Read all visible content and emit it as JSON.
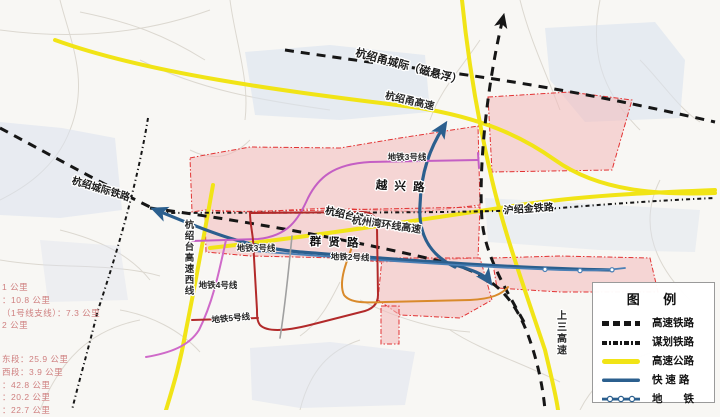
{
  "map_labels": [
    {
      "text": "杭绍甬城际（磁悬浮）"
    },
    {
      "text": "杭绍甬高速"
    },
    {
      "text": "地铁3号线"
    },
    {
      "text": "越 兴 路"
    },
    {
      "text": "杭绍城际铁路"
    },
    {
      "text": "杭绍台铁路"
    },
    {
      "text": "杭州湾环线高速"
    },
    {
      "text": "沪绍金铁路"
    },
    {
      "text": "群 贤 路"
    },
    {
      "text": "地铁3号线"
    },
    {
      "text": "地铁2号线"
    },
    {
      "text": "地铁4号线"
    },
    {
      "text": "地铁5号线"
    },
    {
      "text": "杭绍台高速西线"
    },
    {
      "text": "上三高速"
    }
  ],
  "stats": {
    "lines_a": [
      "1 公里",
      "：10.8 公里",
      "（1号线支线）：7.3 公里",
      "2 公里"
    ],
    "lines_b": [
      "东段：25.9 公里",
      "西段：3.9 公里",
      "：42.8 公里",
      "：20.2 公里",
      "：22.7 公里"
    ]
  },
  "legend": {
    "title": "图 例",
    "items": [
      {
        "label": "高速铁路",
        "swatch": "black-dashed-line"
      },
      {
        "label": "谋划铁路",
        "swatch": "black-dashdot-line"
      },
      {
        "label": "高速公路",
        "swatch": "yellow-line"
      },
      {
        "label": "快 速 路",
        "swatch": "blue-line"
      },
      {
        "label": "地　　铁",
        "swatch": "blue-line-with-stations"
      }
    ]
  },
  "colors": {
    "highway_yellow": "#f1e416",
    "expressway_blue": "#2b5f8e",
    "metro_line2_blue": "#4a7fb5",
    "metro_line3_violet": "#c45fc4",
    "metro_line4_magenta": "#cf6ac9",
    "metro_line5_red": "#b22a2a",
    "orange_road": "#d98a2b",
    "zone_pink": "#f3b9b9",
    "zone_border_red": "#e23333",
    "railway_black": "#161616",
    "stats_text_pink": "#cf8080"
  }
}
